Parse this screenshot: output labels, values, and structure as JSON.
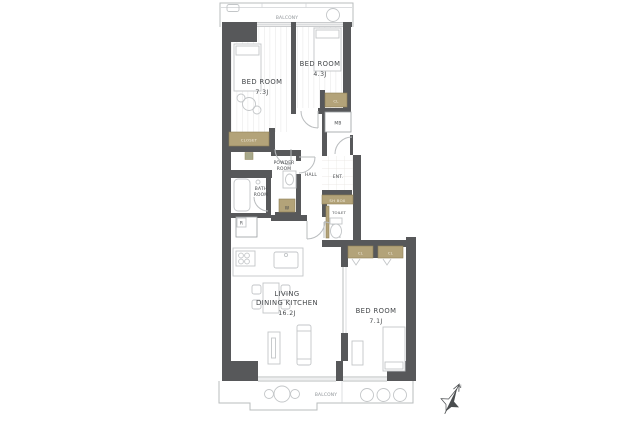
{
  "floorplan": {
    "balcony_top": "BALCONY",
    "balcony_bottom": "BALCONY",
    "compass_north": "N",
    "rooms": {
      "bedroom1": {
        "name": "BED ROOM",
        "size": "7.3J"
      },
      "bedroom2": {
        "name": "BED ROOM",
        "size": "4.3J"
      },
      "bedroom3": {
        "name": "BED ROOM",
        "size": "7.1J"
      },
      "ldk": {
        "name_line1": "LIVING",
        "name_line2": "DINING KITCHEN",
        "size": "16.2J"
      },
      "powder_room": {
        "line1": "POWDER",
        "line2": "ROOM"
      },
      "bath_room": {
        "line1": "BATH",
        "line2": "ROOM"
      },
      "hall": "HALL",
      "entrance": "ENT.",
      "toilet": "TOILET"
    },
    "labels": {
      "meter_box": "MB",
      "washing_machine": "W",
      "refrigerator": "R",
      "shoe_box": "SH BOX",
      "closet_bedroom1": "CLOSET",
      "closet_bedroom2": "CL",
      "closet_bedroom3_left": "CL",
      "closet_bedroom3_right": "CL"
    },
    "colors": {
      "wall": "#57585a",
      "closet_fill": "#b3a379",
      "closet_border": "#8f8157",
      "outline": "#b9bcbe",
      "text_dark": "#45484b",
      "text_light": "#8d9296"
    }
  }
}
